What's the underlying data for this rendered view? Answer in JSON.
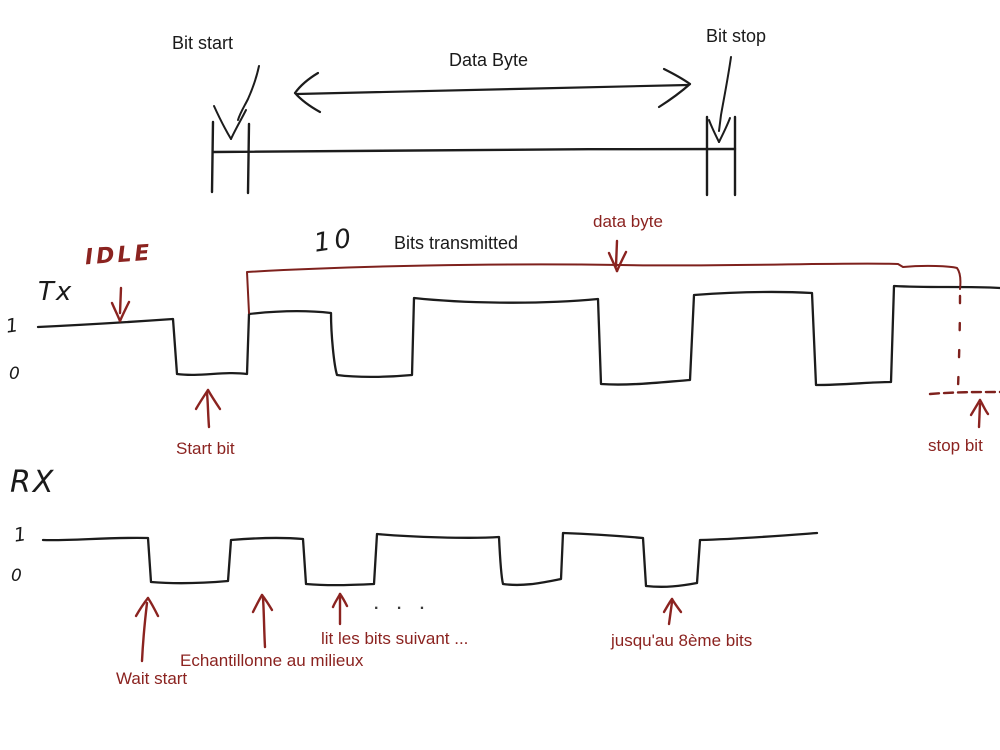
{
  "colors": {
    "ink": "#1c1c1c",
    "accent_red": "#8b2320"
  },
  "top": {
    "bit_start": "Bit start",
    "data_byte": "Data Byte",
    "bit_stop": "Bit stop"
  },
  "tx": {
    "idle_label": "IDLE",
    "line_label": "Tx",
    "level_high": "1",
    "level_low": "0",
    "bits_count": "10",
    "bits_transmitted": "Bits transmitted",
    "data_byte_label": "data byte",
    "start_bit_label": "Start bit",
    "stop_bit_label": "stop bit"
  },
  "rx": {
    "line_label": "RX",
    "level_high": "1",
    "level_low": "0",
    "ellipsis": ". . .",
    "wait_start_label": "Wait start",
    "sample_label": "Echantillonne au milieux",
    "read_next_label": "lit les bits suivant ...",
    "until_eighth_label": "jusqu'au 8ème bits"
  }
}
